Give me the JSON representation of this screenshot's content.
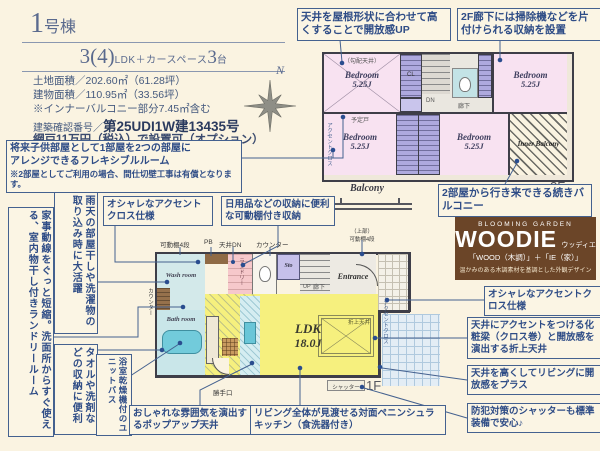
{
  "header": {
    "building_num": "1",
    "building_suffix": "号棟",
    "plan_num": "3(4)",
    "plan_mid": "LDK＋カースペース",
    "plan_count": "3",
    "plan_count_suffix": "台",
    "spec_land": "土地面積／202.60㎡（61.28坪）",
    "spec_building": "建物面積／110.95㎡（33.56坪）",
    "spec_balcony_note": "※インナーバルコニー部分7.45㎡含む",
    "approval_label": "建築確認番号／",
    "approval_value": "第25UDI1W建13435号",
    "screen_option": "網戸11万円（税込）で設置可（オプション）",
    "compass_n": "N"
  },
  "flex_note": {
    "line1": "将来子供部屋として1部屋を2つの部屋に",
    "line2": "アレンジできるフレキシブルルーム",
    "line3": "※2部屋としてご利用の場合、間仕切壁工事は有償となります。"
  },
  "side_notes": {
    "laundry": "家事動線をぐっと短縮。洗面所からすぐ使える、室内物干し付きランドリールーム",
    "rainy": "雨天の部屋干しや洗濯物の取り込み時に大活躍",
    "towel": "タオルや洗剤などの収納に便利",
    "bath_dryer": "浴室乾燥機付のユニットバス"
  },
  "callouts": {
    "roof_ceiling": "天井を屋根形状に合わせて高くすることで開放感UP",
    "hall_storage": "2F廊下には掃除機などを片付けられる収納を設置",
    "twin_balcony": "2部屋から行き来できる続きバルコニー",
    "accent_cross_1f": "オシャレなアクセントクロス仕様",
    "movable_shelf": "日用品などの収納に便利な可動棚付き収納",
    "popup_ceiling": "おしゃれな雰囲気を演出するポップアップ天井",
    "peninsula_kitchen": "リビング全体が見渡せる対面ペニンシュラキッチン（食洗器付き）",
    "accent_cross_living": "オシャレなアクセントクロス仕様",
    "beam_ceiling": "天井にアクセントをつける化粧梁（クロス巻）と開放感を演出する折上天井",
    "high_ceiling": "天井を高くしてリビングに開放感をプラス",
    "shutter": "防犯対策のシャッターも標準装備で安心♪"
  },
  "logo": {
    "brand": "BLOOMING GARDEN",
    "name": "WOODIE",
    "kana": "ウッディエ",
    "formula": "「WOOD（木調）」＋「IE（家）」",
    "tagline": "温かみのある木調素材を基調とした外観デザイン"
  },
  "floor2": {
    "label": "2F",
    "balcony": "Balcony",
    "inner_balcony": "Inner Balcony",
    "bedrooms": [
      {
        "name": "Bedroom",
        "size": "5.25J"
      },
      {
        "name": "Bedroom",
        "size": "5.25J"
      },
      {
        "name": "Bedroom",
        "size": "5.25J"
      }
    ],
    "sloped_ceiling": "（勾配天井）",
    "partition": "予定戸",
    "accent_wall": "アクセントクロス",
    "closet": "CL",
    "dn": "DN",
    "hallway": "廊下"
  },
  "floor1": {
    "label": "1F",
    "ldk_name": "LDK",
    "ldk_size": "18.0J",
    "entrance": "Entrance",
    "wash_room": "Wash room",
    "bath_room": "Bath room",
    "laundry": "ランドリー",
    "sto": "Sto",
    "up": "UP",
    "hallway": "廊下",
    "back_door": "勝手口",
    "shutter": "シャッター",
    "counter": "カウンター",
    "counter_side": "カウンター",
    "pb": "PB",
    "ceiling_dn": "天井DN",
    "shelf": "可動棚4段",
    "entrance_shelf_1": "（上部）",
    "entrance_shelf_2": "可動棚4段",
    "oriage": "折上天井",
    "accent_wall": "アクセントクロス"
  },
  "colors": {
    "background": "#FAF3E1",
    "accent_blue": "#44618F",
    "text_blue": "#2E4C86",
    "room_pink": "#F8E2F1",
    "closet_purple": "#AEA9DE",
    "ldk_yellow": "#F6F07E",
    "bath_cyan": "#CDE8E9",
    "laundry_pink": "#F6C8CB",
    "logo_brown": "#6B4528"
  }
}
